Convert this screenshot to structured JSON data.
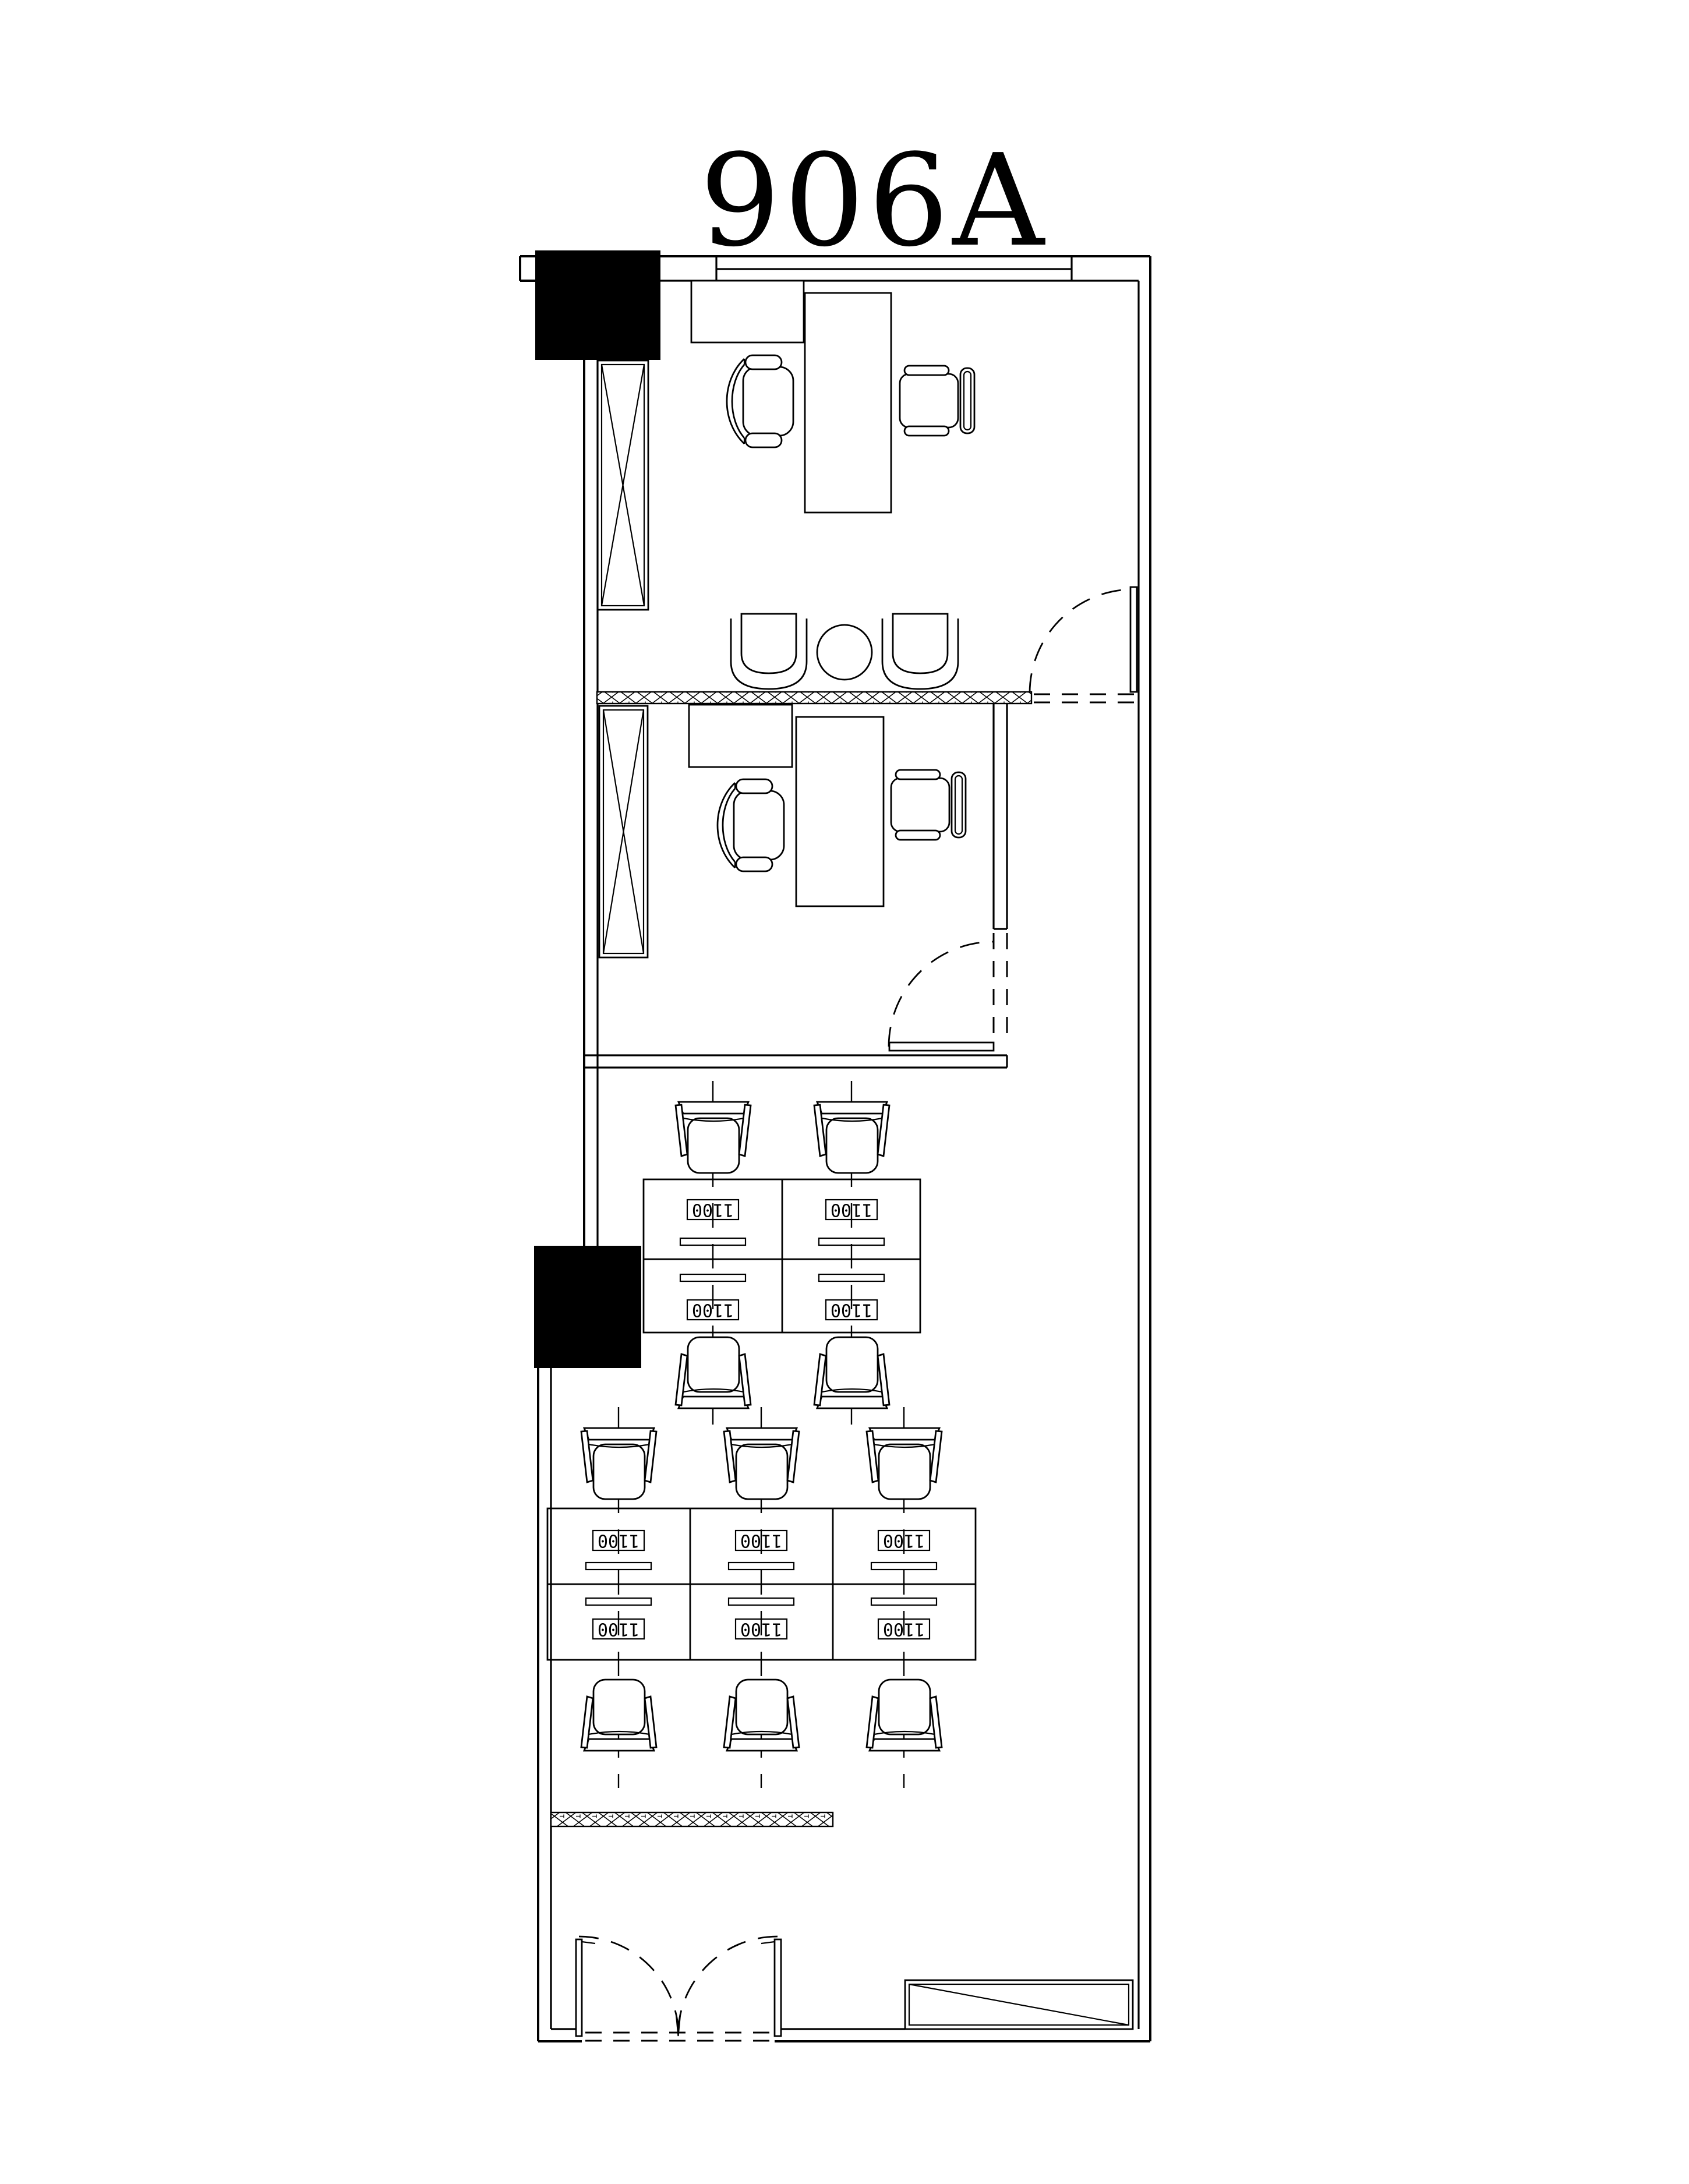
{
  "plan": {
    "title": "906A",
    "desk_label": "1100",
    "colors": {
      "line": "#000000",
      "background": "#ffffff",
      "column_fill": "#000000"
    },
    "workstations": {
      "group_1_count": 4,
      "group_2_count": 6
    }
  }
}
